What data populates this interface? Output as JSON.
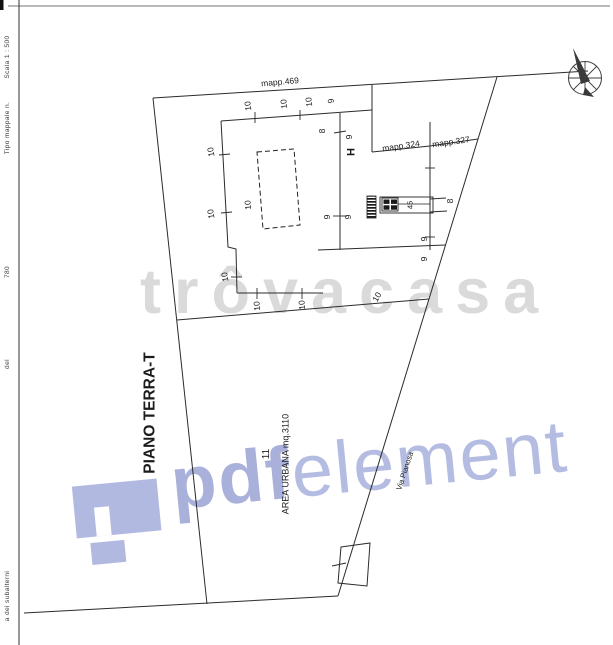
{
  "left_margin": {
    "fragments": [
      {
        "t": "Scala 1 : 500",
        "x": 8,
        "y": 57
      },
      {
        "t": "Tipo mappale n.",
        "x": 8,
        "y": 128
      },
      {
        "t": "780",
        "x": 8,
        "y": 272
      },
      {
        "t": "del",
        "x": 8,
        "y": 364
      },
      {
        "t": "a dei subalterni",
        "x": 8,
        "y": 596
      }
    ]
  },
  "plan": {
    "labels": [
      {
        "t": "PIANO TERRA-T",
        "x": 150,
        "y": 413,
        "r": -90,
        "s": 15.5,
        "b": 1,
        "n": "floor-title"
      },
      {
        "t": "mapp.469",
        "x": 280,
        "y": 82,
        "r": -5,
        "s": 8.5,
        "n": "parcel-label"
      },
      {
        "t": "mapp.324",
        "x": 401,
        "y": 146,
        "r": -8,
        "s": 8.5,
        "n": "parcel-label"
      },
      {
        "t": "mapp.327",
        "x": 451,
        "y": 142,
        "r": -8,
        "s": 8.5,
        "n": "parcel-label"
      },
      {
        "t": "10",
        "x": 248,
        "y": 106,
        "r": -97
      },
      {
        "t": "10",
        "x": 284,
        "y": 104,
        "r": -97
      },
      {
        "t": "10",
        "x": 309,
        "y": 102,
        "r": -97
      },
      {
        "t": "9",
        "x": 331,
        "y": 101,
        "r": -97
      },
      {
        "t": "8",
        "x": 322,
        "y": 131,
        "r": -90
      },
      {
        "t": "9",
        "x": 349,
        "y": 137,
        "r": -90
      },
      {
        "t": "10",
        "x": 211,
        "y": 152,
        "r": -100
      },
      {
        "t": "10",
        "x": 211,
        "y": 214,
        "r": -100
      },
      {
        "t": "10",
        "x": 225,
        "y": 277,
        "r": -100
      },
      {
        "t": "10",
        "x": 257,
        "y": 306,
        "r": -95
      },
      {
        "t": "10",
        "x": 302,
        "y": 305,
        "r": -95
      },
      {
        "t": "10",
        "x": 377,
        "y": 297,
        "r": -60
      },
      {
        "t": "10",
        "x": 248,
        "y": 205,
        "r": -95
      },
      {
        "t": "9",
        "x": 327,
        "y": 217,
        "r": -90
      },
      {
        "t": "9",
        "x": 348,
        "y": 217,
        "r": -90
      },
      {
        "t": "8",
        "x": 450,
        "y": 201,
        "r": -90
      },
      {
        "t": "9",
        "x": 424,
        "y": 239,
        "r": -90
      },
      {
        "t": "9",
        "x": 424,
        "y": 259,
        "r": -90
      },
      {
        "t": "45",
        "x": 410,
        "y": 205,
        "r": -90,
        "s": 7.5
      },
      {
        "t": "11",
        "x": 267,
        "y": 454,
        "r": -90,
        "s": 10,
        "n": "parcel-number"
      },
      {
        "t": "H",
        "x": 352,
        "y": 152,
        "r": -90,
        "s": 11,
        "b": 1,
        "n": "well-symbol"
      },
      {
        "t": "AREA URBANA  mq.3110",
        "x": 286,
        "y": 464,
        "r": -90,
        "s": 9,
        "n": "area-label"
      },
      {
        "t": "Via Pianosa",
        "x": 405,
        "y": 471,
        "r": -72,
        "s": 7.5,
        "n": "road-label"
      }
    ]
  },
  "watermarks": {
    "trovacasa": {
      "text": "trôvacasa",
      "color": "#cbcbcb"
    },
    "pdfelement": {
      "pdf": "pdf",
      "element": "element",
      "logo_color": "#b2b9e0",
      "pdf_color": "#a9b1db",
      "element_color": "#b4bce2"
    }
  }
}
